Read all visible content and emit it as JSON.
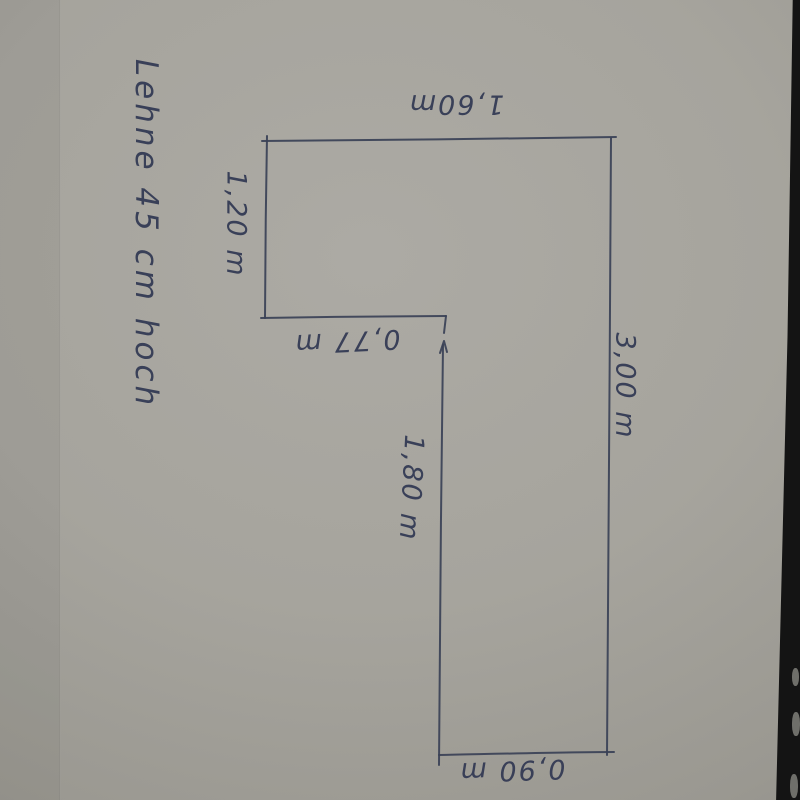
{
  "sketch": {
    "annotation": "Lehne 45 cm hoch",
    "dimensions": {
      "top": "1,60m",
      "left": "1,20 m",
      "inner_width": "0,77 m",
      "right": "3,00 m",
      "inner_height": "1,80 m",
      "bottom": "0,90 m"
    },
    "shape": "L-shaped outline (corner bench plan), hand drawn in pen",
    "colors": {
      "ink": "#3a4156",
      "paper": "#a2a09a",
      "table_edge": "#141414"
    }
  }
}
